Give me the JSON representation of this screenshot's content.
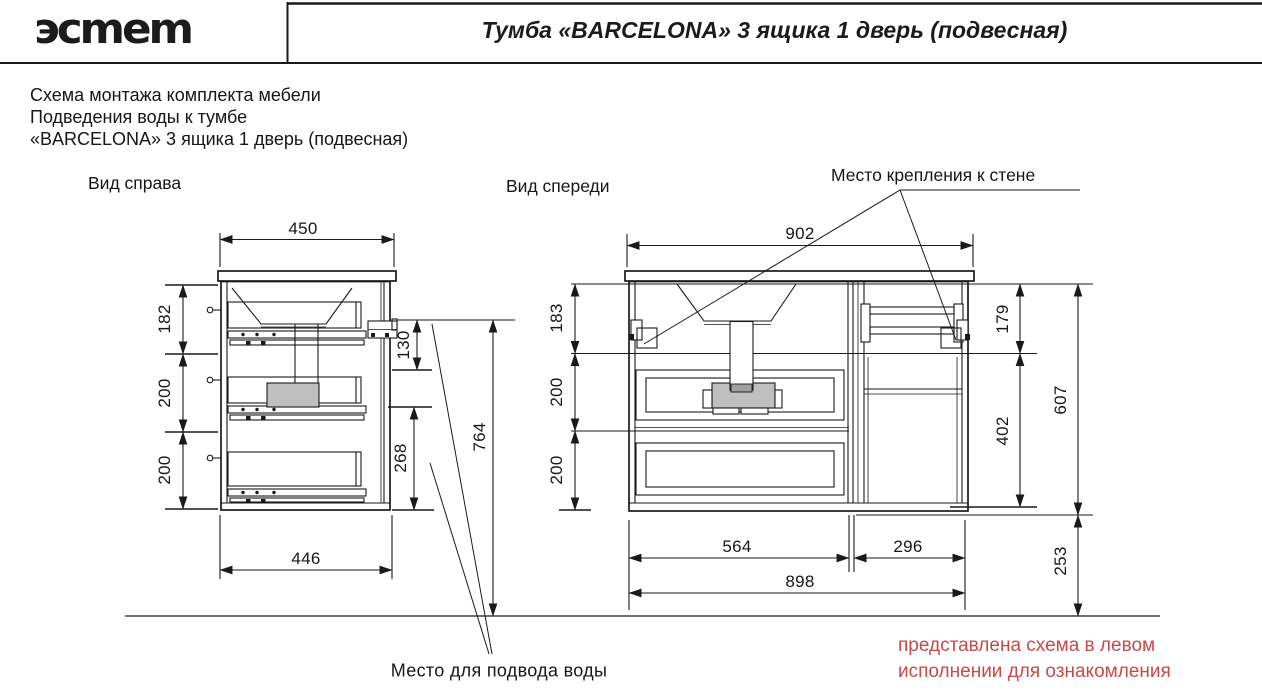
{
  "header": {
    "logo": "эcmem",
    "title": "Тумба «BARCELONA» 3 ящика 1 дверь (подвесная)"
  },
  "subheader": {
    "line1": "Схема монтажа комплекта мебели",
    "line2": "Подведения воды к тумбе",
    "line3": "«BARCELONA» 3 ящика 1 дверь (подвесная)"
  },
  "side_view": {
    "label": "Вид справа",
    "dims": {
      "top_width": "450",
      "seg1": "182",
      "seg2": "200",
      "seg3": "200",
      "bracket_drop": "130",
      "lower_height": "268",
      "mount_height": "764",
      "bottom_width": "446"
    }
  },
  "front_view": {
    "label": "Вид спереди",
    "dims": {
      "top_width": "902",
      "seg1": "183",
      "seg2": "200",
      "seg3": "200",
      "right_top": "179",
      "right_mid": "402",
      "total_height": "607",
      "floor_gap": "253",
      "drawer_width": "564",
      "door_width": "296",
      "bottom_width": "898"
    }
  },
  "labels": {
    "wall_mount": "Место крепления к стене",
    "water_supply": "Место для подвода воды"
  },
  "note": {
    "line1": "представлена схема в левом",
    "line2": "исполнении для ознакомления",
    "color": "#c64a4a"
  }
}
